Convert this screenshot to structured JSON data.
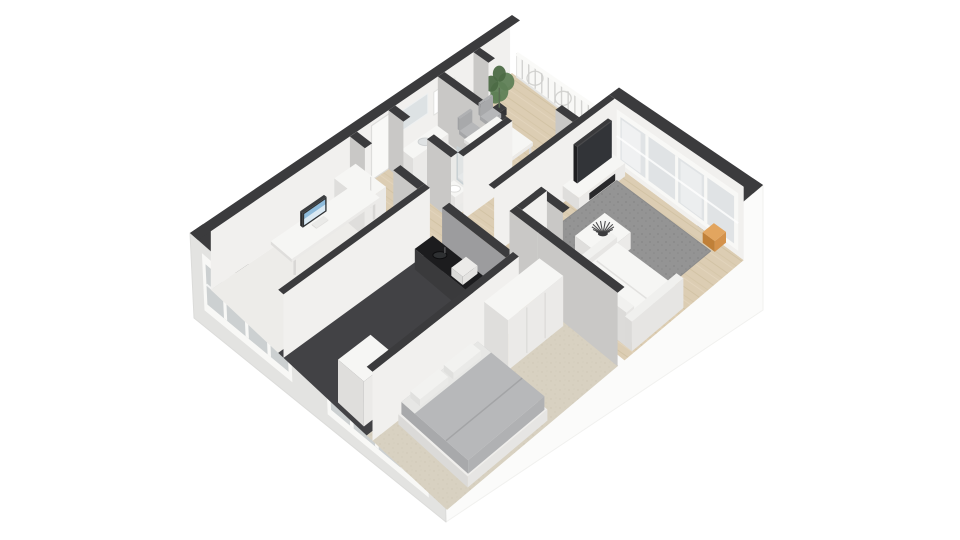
{
  "app": {
    "name": "3D floor plan rendering",
    "background": "#ffffff"
  },
  "colors": {
    "background": "#ffffff",
    "wall_cap": "#3b3b3d",
    "wall_face_light": "#f1f0ee",
    "wall_face_mid": "#c9c8c6",
    "wall_face_kitchen": "#9c9c9e",
    "ext_sw_face": "#e3e3e1",
    "ext_se_face": "#fbfbfa",
    "window_frame": "#f8f8f6",
    "window_glass": "#ccd0d1",
    "window_glass_ne": "#e0e3e5",
    "sheer_curtain": "#ffffff",
    "wood_floor": "#dccdb3",
    "wood_streak": "#cdbd9e",
    "office_floor": "#edece9",
    "bath_floor": "#eaeae8",
    "kitchen_floor": "#424245",
    "closet_floor": "#39393b",
    "carpet": "#d8d1c1",
    "carpet_dot": "#cbc3b1",
    "rug": "#949494",
    "rug_dot": "#828282",
    "furn_top": "#f6f6f4",
    "furn_sw": "#dfdedc",
    "furn_se": "#ebeae8",
    "tv_top": "#3a3a3c",
    "tv_side": "#1f1f21",
    "tv_screen": "#323438",
    "stand_inset": "#29292b",
    "chair_seat": "#b6b7b9",
    "chair_sw": "#a5a6a8",
    "chair_se": "#aeafb1",
    "bed_blanket": "#b7b8ba",
    "bed_blanket_sw": "#a8a9ab",
    "bed_blanket_se": "#b0b1b3",
    "bed_sheet": "#e9e9e7",
    "pillow": "#f2f2f0",
    "counter_top": "#1c1c1e",
    "counter_sw": "#3a3a3c",
    "counter_se": "#101012",
    "plant_green": "#5f7f56",
    "plant_green_dark": "#4c6a45",
    "plant_pot": "#3c3c3e",
    "art_red": "#c0452f",
    "art_blue": "#3f6fa8",
    "pouf_top": "#e2a55f",
    "pouf_sw": "#c08038",
    "pouf_se": "#d4924b",
    "door_white": "#f9f9f7",
    "mirror": "#dde2e4",
    "railing_panel": "#f7f7f5",
    "railing_slat": "#cfcfcd",
    "shower_glass_stroke": "#c8d0d3",
    "centerpiece_dark": "#3c3c3e"
  },
  "scene": {
    "view": "isometric-3d-floorplan",
    "rooms": [
      {
        "id": "living-room",
        "label": "living room"
      },
      {
        "id": "dining-area",
        "label": "dining area"
      },
      {
        "id": "hallway",
        "label": "hallway"
      },
      {
        "id": "bathroom",
        "label": "bathroom"
      },
      {
        "id": "office",
        "label": "office"
      },
      {
        "id": "kitchen",
        "label": "kitchen"
      },
      {
        "id": "bedroom",
        "label": "bedroom"
      },
      {
        "id": "closet",
        "label": "closet"
      },
      {
        "id": "balcony",
        "label": "balcony"
      }
    ],
    "furniture": [
      {
        "id": "sofa",
        "label": "white L-shaped sofa"
      },
      {
        "id": "coffee-table",
        "label": "coffee table with decorative bowl"
      },
      {
        "id": "area-rug",
        "label": "gray area rug"
      },
      {
        "id": "tv",
        "label": "flat screen TV"
      },
      {
        "id": "tv-stand",
        "label": "TV stand"
      },
      {
        "id": "dining-table",
        "label": "dining table"
      },
      {
        "id": "dining-chairs",
        "label": "gray dining chairs"
      },
      {
        "id": "console-table",
        "label": "console table"
      },
      {
        "id": "wall-art",
        "label": "abstract wall art"
      },
      {
        "id": "potted-plant",
        "label": "potted plant"
      },
      {
        "id": "desk",
        "label": "office desk"
      },
      {
        "id": "monitor",
        "label": "desktop monitor"
      },
      {
        "id": "office-chair",
        "label": "office chair"
      },
      {
        "id": "office-cabinet",
        "label": "office cabinet"
      },
      {
        "id": "kitchen-counter",
        "label": "kitchen counter"
      },
      {
        "id": "fridge",
        "label": "refrigerator"
      },
      {
        "id": "bathroom-sink",
        "label": "bathroom sink"
      },
      {
        "id": "shower",
        "label": "shower"
      },
      {
        "id": "toilet",
        "label": "toilet"
      },
      {
        "id": "bed",
        "label": "double bed"
      },
      {
        "id": "wardrobe",
        "label": "wardrobe"
      },
      {
        "id": "pouf",
        "label": "orange pouf"
      },
      {
        "id": "balcony-railing",
        "label": "decorative balcony railing"
      },
      {
        "id": "entrance-door",
        "label": "entrance door"
      },
      {
        "id": "windows",
        "label": "exterior windows"
      }
    ]
  }
}
